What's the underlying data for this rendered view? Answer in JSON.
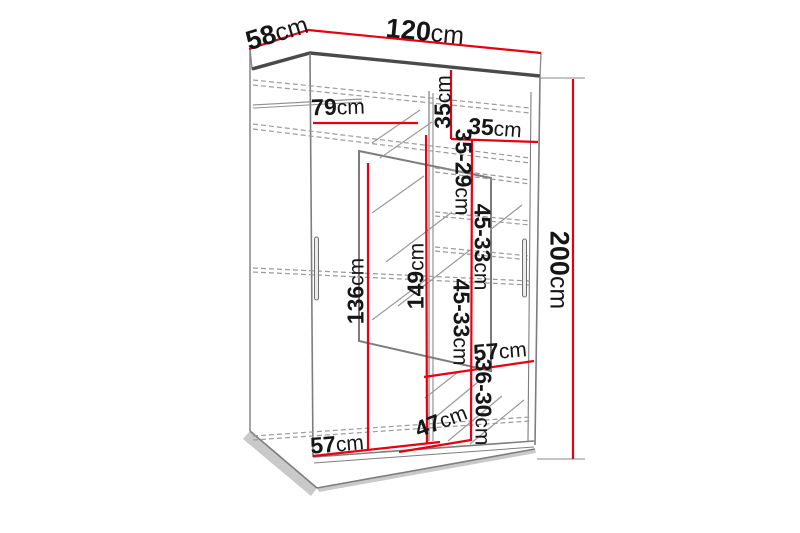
{
  "diagram": {
    "kind": "wardrobe-dimension-drawing",
    "unit": "cm",
    "overall": {
      "width": "120",
      "depth": "58",
      "height": "200"
    },
    "colors": {
      "dimension_line": "#e60012",
      "outline": "#7d7d7d",
      "outline_dark": "#4a4a4a",
      "hidden_line": "#9a9a9a",
      "text": "#161616",
      "background": "#ffffff"
    },
    "labels": [
      {
        "id": "depth-top",
        "value": "58",
        "unit": "cm"
      },
      {
        "id": "width-top",
        "value": "120",
        "unit": "cm"
      },
      {
        "id": "shelf-width-left",
        "value": "79",
        "unit": "cm"
      },
      {
        "id": "top-section-height",
        "value": "35",
        "unit": "cm"
      },
      {
        "id": "shelf-width-right",
        "value": "35",
        "unit": "cm"
      },
      {
        "id": "gap-35-29",
        "value": "35-29",
        "unit": "cm"
      },
      {
        "id": "gap-45-33-upper",
        "value": "45-33",
        "unit": "cm"
      },
      {
        "id": "gap-45-33-lower",
        "value": "45-33",
        "unit": "cm"
      },
      {
        "id": "gap-36-30",
        "value": "36-30",
        "unit": "cm"
      },
      {
        "id": "shelf-width-mid",
        "value": "57",
        "unit": "cm"
      },
      {
        "id": "interior-depth",
        "value": "47",
        "unit": "cm"
      },
      {
        "id": "shelf-width-bottom",
        "value": "57",
        "unit": "cm"
      },
      {
        "id": "hanging-height-left",
        "value": "136",
        "unit": "cm"
      },
      {
        "id": "hanging-height-mid",
        "value": "149",
        "unit": "cm"
      },
      {
        "id": "height-right",
        "value": "200",
        "unit": "cm"
      }
    ]
  }
}
